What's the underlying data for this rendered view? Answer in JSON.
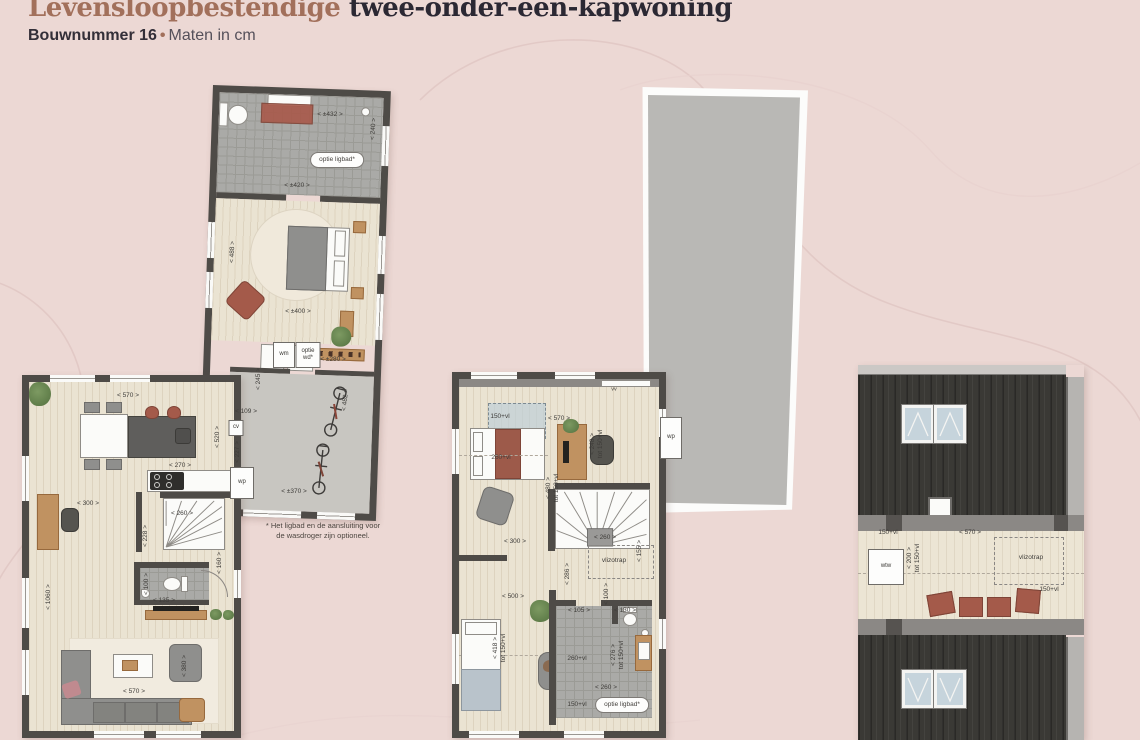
{
  "page": {
    "title_accent": "Levensloopbestendige",
    "title_rest": " twee-onder-een-kapwoning",
    "subtitle_bold": "Bouwnummer 16",
    "subtitle_sep": "•",
    "subtitle_rest": "Maten in cm"
  },
  "colors": {
    "background": "#ECD8D4",
    "title_accent": "#A2705B",
    "title_dark": "#2B2833",
    "wall": "#4E4B47",
    "roof_dark": "#3A3935",
    "skylight_blue": "#C6D4DC",
    "terracotta": "#A45A4A"
  },
  "labels": [
    {
      "t": "< ±432 >",
      "x": 330,
      "y": 115
    },
    {
      "t": "< 240 >",
      "x": 374,
      "y": 129,
      "r": -86
    },
    {
      "t": "optie ligbad*",
      "x": 337,
      "y": 160,
      "kind": "pill",
      "name": "bathtub-option-pill"
    },
    {
      "t": "< ±420 >",
      "x": 297,
      "y": 186
    },
    {
      "t": "< 488 >",
      "x": 233,
      "y": 252,
      "r": -88
    },
    {
      "t": "< ±400 >",
      "x": 298,
      "y": 312
    },
    {
      "t": "wm",
      "x": 284,
      "y": 355,
      "kind": "box",
      "name": "washing-machine-label",
      "w": 20,
      "h": 24
    },
    {
      "t": "optie\nwd*",
      "x": 308,
      "y": 355,
      "kind": "box",
      "name": "dryer-option-label",
      "w": 23,
      "h": 24
    },
    {
      "t": "< ±280 >",
      "x": 333,
      "y": 360
    },
    {
      "t": "< 245 >",
      "x": 259,
      "y": 379,
      "r": -90
    },
    {
      "t": "< 109 >",
      "x": 246,
      "y": 412
    },
    {
      "t": "cv",
      "x": 236,
      "y": 428,
      "kind": "box",
      "name": "cv-boiler-label",
      "w": 13,
      "h": 14
    },
    {
      "t": "< 520 >",
      "x": 218,
      "y": 437,
      "r": -90
    },
    {
      "t": "< 227 >",
      "x": 238,
      "y": 452,
      "r": -90
    },
    {
      "t": "< 482 >",
      "x": 346,
      "y": 400,
      "r": -84
    },
    {
      "t": "wp",
      "x": 242,
      "y": 483,
      "kind": "box",
      "name": "heat-pump-label",
      "w": 22,
      "h": 30
    },
    {
      "t": "< ±370 >",
      "x": 294,
      "y": 492
    },
    {
      "t": "* Het ligbad en de aansluiting voor\nde wasdroger zijn optioneel.",
      "x": 323,
      "y": 531,
      "kind": "note",
      "name": "options-footnote"
    },
    {
      "t": "< 570 >",
      "x": 128,
      "y": 396
    },
    {
      "t": "< 270 >",
      "x": 180,
      "y": 466
    },
    {
      "t": "< 300 >",
      "x": 88,
      "y": 504
    },
    {
      "t": "< 260 >",
      "x": 182,
      "y": 514
    },
    {
      "t": "< 228 >",
      "x": 146,
      "y": 536,
      "r": -90
    },
    {
      "t": "< 1060 >",
      "x": 49,
      "y": 597,
      "r": -90
    },
    {
      "t": "< 160 >",
      "x": 220,
      "y": 563,
      "r": -90
    },
    {
      "t": "< 100 >",
      "x": 147,
      "y": 584,
      "r": -90
    },
    {
      "t": "< 135 >",
      "x": 164,
      "y": 601
    },
    {
      "t": "< 380 >",
      "x": 185,
      "y": 666,
      "r": -90
    },
    {
      "t": "< 570 >",
      "x": 134,
      "y": 692
    },
    {
      "t": "vv",
      "x": 614,
      "y": 390,
      "kind": "tiny",
      "name": "vv-label"
    },
    {
      "t": "150+vl",
      "x": 500,
      "y": 417
    },
    {
      "t": "< 570 >",
      "x": 559,
      "y": 419
    },
    {
      "t": "260+vl",
      "x": 501,
      "y": 458
    },
    {
      "t": "< 248 >\ntot 150+vl",
      "x": 597,
      "y": 444,
      "r": -90
    },
    {
      "t": "< 480 >\ntot 150+vl",
      "x": 553,
      "y": 488,
      "r": -90
    },
    {
      "t": "< 300 >",
      "x": 515,
      "y": 542
    },
    {
      "t": "< 260 >",
      "x": 605,
      "y": 538
    },
    {
      "t": "vlizotrap",
      "x": 614,
      "y": 561,
      "name": "loft-ladder-label"
    },
    {
      "t": "< 155 >",
      "x": 640,
      "y": 551,
      "r": -90
    },
    {
      "t": "< 286 >",
      "x": 568,
      "y": 574,
      "r": -90
    },
    {
      "t": "< 500 >",
      "x": 513,
      "y": 597
    },
    {
      "t": "< 105 >",
      "x": 579,
      "y": 611
    },
    {
      "t": "< 130 >",
      "x": 625,
      "y": 611
    },
    {
      "t": "< 100 >",
      "x": 607,
      "y": 594,
      "r": -90
    },
    {
      "t": "< 418 >\ntot 150+vl",
      "x": 500,
      "y": 648,
      "r": -90
    },
    {
      "t": "260+vl",
      "x": 577,
      "y": 659
    },
    {
      "t": "< 276 >\ntot 150+vl",
      "x": 618,
      "y": 655,
      "r": -90
    },
    {
      "t": "< 260 >",
      "x": 606,
      "y": 688
    },
    {
      "t": "150+vl",
      "x": 577,
      "y": 705
    },
    {
      "t": "optie ligbad*",
      "x": 622,
      "y": 705,
      "kind": "pill",
      "name": "bathtub-option-pill"
    },
    {
      "t": "wp",
      "x": 671,
      "y": 438,
      "kind": "box",
      "name": "heat-pump-label",
      "w": 20,
      "h": 40
    },
    {
      "t": "150+vl",
      "x": 888,
      "y": 533
    },
    {
      "t": "< 570 >",
      "x": 970,
      "y": 533
    },
    {
      "t": "< 200 >\ntot 150+vl",
      "x": 914,
      "y": 558,
      "r": -90
    },
    {
      "t": "wtw",
      "x": 886,
      "y": 567,
      "kind": "box",
      "name": "ventilation-unit-label",
      "w": 34,
      "h": 34
    },
    {
      "t": "vlizotrap",
      "x": 1031,
      "y": 558,
      "name": "loft-ladder-label"
    },
    {
      "t": "150+vl",
      "x": 1049,
      "y": 590
    }
  ]
}
